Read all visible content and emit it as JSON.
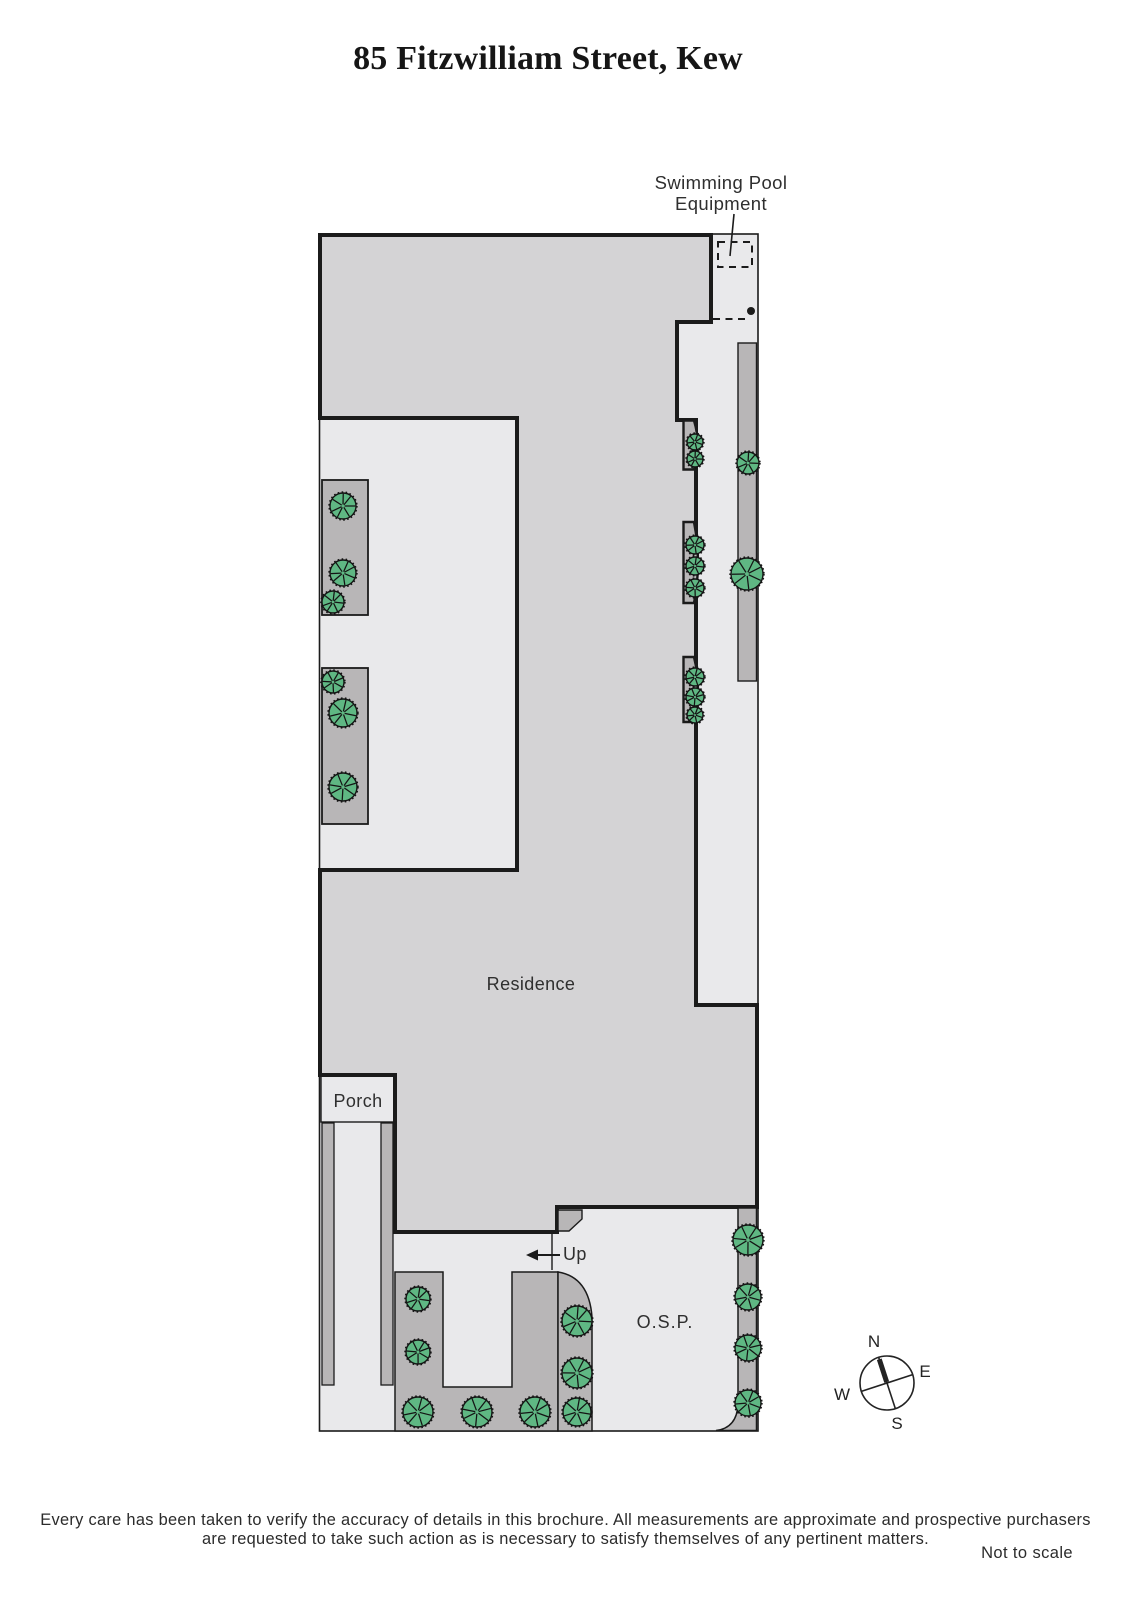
{
  "title": "85 Fitzwilliam Street, Kew",
  "labels": {
    "pool_line1": "Swimming Pool",
    "pool_line2": "Equipment",
    "residence": "Residence",
    "porch": "Porch",
    "up": "Up",
    "osp": "O.S.P.",
    "not_to_scale": "Not to scale"
  },
  "compass": {
    "n": "N",
    "e": "E",
    "s": "S",
    "w": "W"
  },
  "disclaimer": {
    "line1": "Every care has been taken to verify the accuracy of details in this brochure.  All measurements are approximate and prospective purchasers",
    "line2": "are requested to take such action as is necessary to satisfy themselves of any pertinent matters."
  },
  "colors": {
    "path_light": "#e9e9eb",
    "residence_fill": "#d4d3d5",
    "garden_bed": "#b8b6b7",
    "tree_green": "#5fb783",
    "line": "#1b1b1b"
  },
  "plan": {
    "trees": [
      [
        343,
        506,
        13
      ],
      [
        343,
        573,
        13
      ],
      [
        333,
        602,
        11
      ],
      [
        333,
        682,
        11
      ],
      [
        343,
        713,
        14
      ],
      [
        343,
        787,
        14
      ],
      [
        695,
        442,
        8
      ],
      [
        695,
        459,
        8
      ],
      [
        695,
        545,
        9
      ],
      [
        695,
        566,
        9
      ],
      [
        695,
        588,
        9
      ],
      [
        695,
        677,
        9
      ],
      [
        695,
        697,
        9
      ],
      [
        695,
        715,
        8
      ],
      [
        748,
        463,
        11
      ],
      [
        747,
        574,
        16
      ],
      [
        418,
        1299,
        12
      ],
      [
        418,
        1352,
        12
      ],
      [
        418,
        1412,
        15
      ],
      [
        477,
        1412,
        15
      ],
      [
        535,
        1412,
        15
      ],
      [
        577,
        1321,
        15
      ],
      [
        577,
        1373,
        15
      ],
      [
        577,
        1412,
        14
      ],
      [
        748,
        1240,
        15
      ],
      [
        748,
        1297,
        13
      ],
      [
        748,
        1348,
        13
      ],
      [
        748,
        1403,
        13
      ]
    ]
  }
}
